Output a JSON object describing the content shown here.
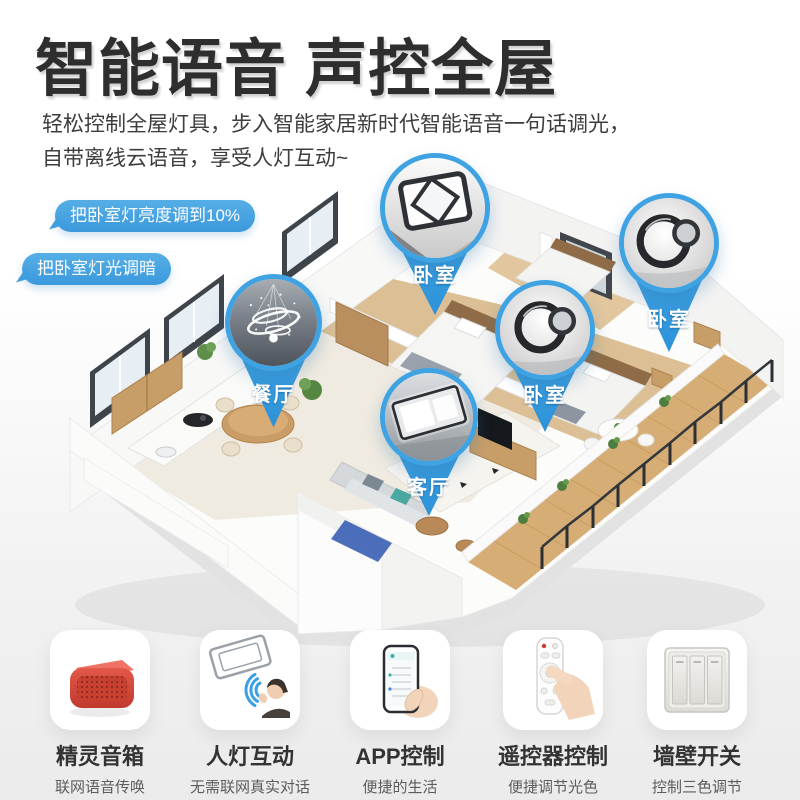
{
  "page": {
    "title": "智能语音 声控全屋",
    "subtitle_line1": "轻松控制全屋灯具，步入智能家居新时代智能语音一句话调光，",
    "subtitle_line2": "自带离线云语音，享受人灯互动~"
  },
  "colors": {
    "accent_blue": "#3fa3e3",
    "bubble_blue": "#3b99dc",
    "title_color": "#2e2e2e",
    "background_bottom": "#ebebeb"
  },
  "voice_commands": [
    {
      "text": "把卧室灯亮度调到10%"
    },
    {
      "text": "把卧室灯光调暗"
    }
  ],
  "floorplan": {
    "description": "3D isometric apartment cutaway with room lighting pins",
    "pins": [
      {
        "label": "卧室",
        "light": "square-ceiling-light"
      },
      {
        "label": "卧室",
        "light": "double-ring-ceiling-light"
      },
      {
        "label": "餐厅",
        "light": "ring-chandelier"
      },
      {
        "label": "卧室",
        "light": "double-ring-ceiling-light"
      },
      {
        "label": "客厅",
        "light": "rectangular-ceiling-light"
      }
    ]
  },
  "features": [
    {
      "title": "精灵音箱",
      "subtitle": "联网语音传唤",
      "icon": "smart-speaker"
    },
    {
      "title": "人灯互动",
      "subtitle": "无需联网真实对话",
      "icon": "voice-interaction"
    },
    {
      "title": "APP控制",
      "subtitle": "便捷的生活",
      "icon": "app-phone"
    },
    {
      "title": "遥控器控制",
      "subtitle": "便捷调节光色",
      "icon": "remote-control"
    },
    {
      "title": "墙壁开关",
      "subtitle": "控制三色调节",
      "icon": "wall-switch"
    }
  ]
}
